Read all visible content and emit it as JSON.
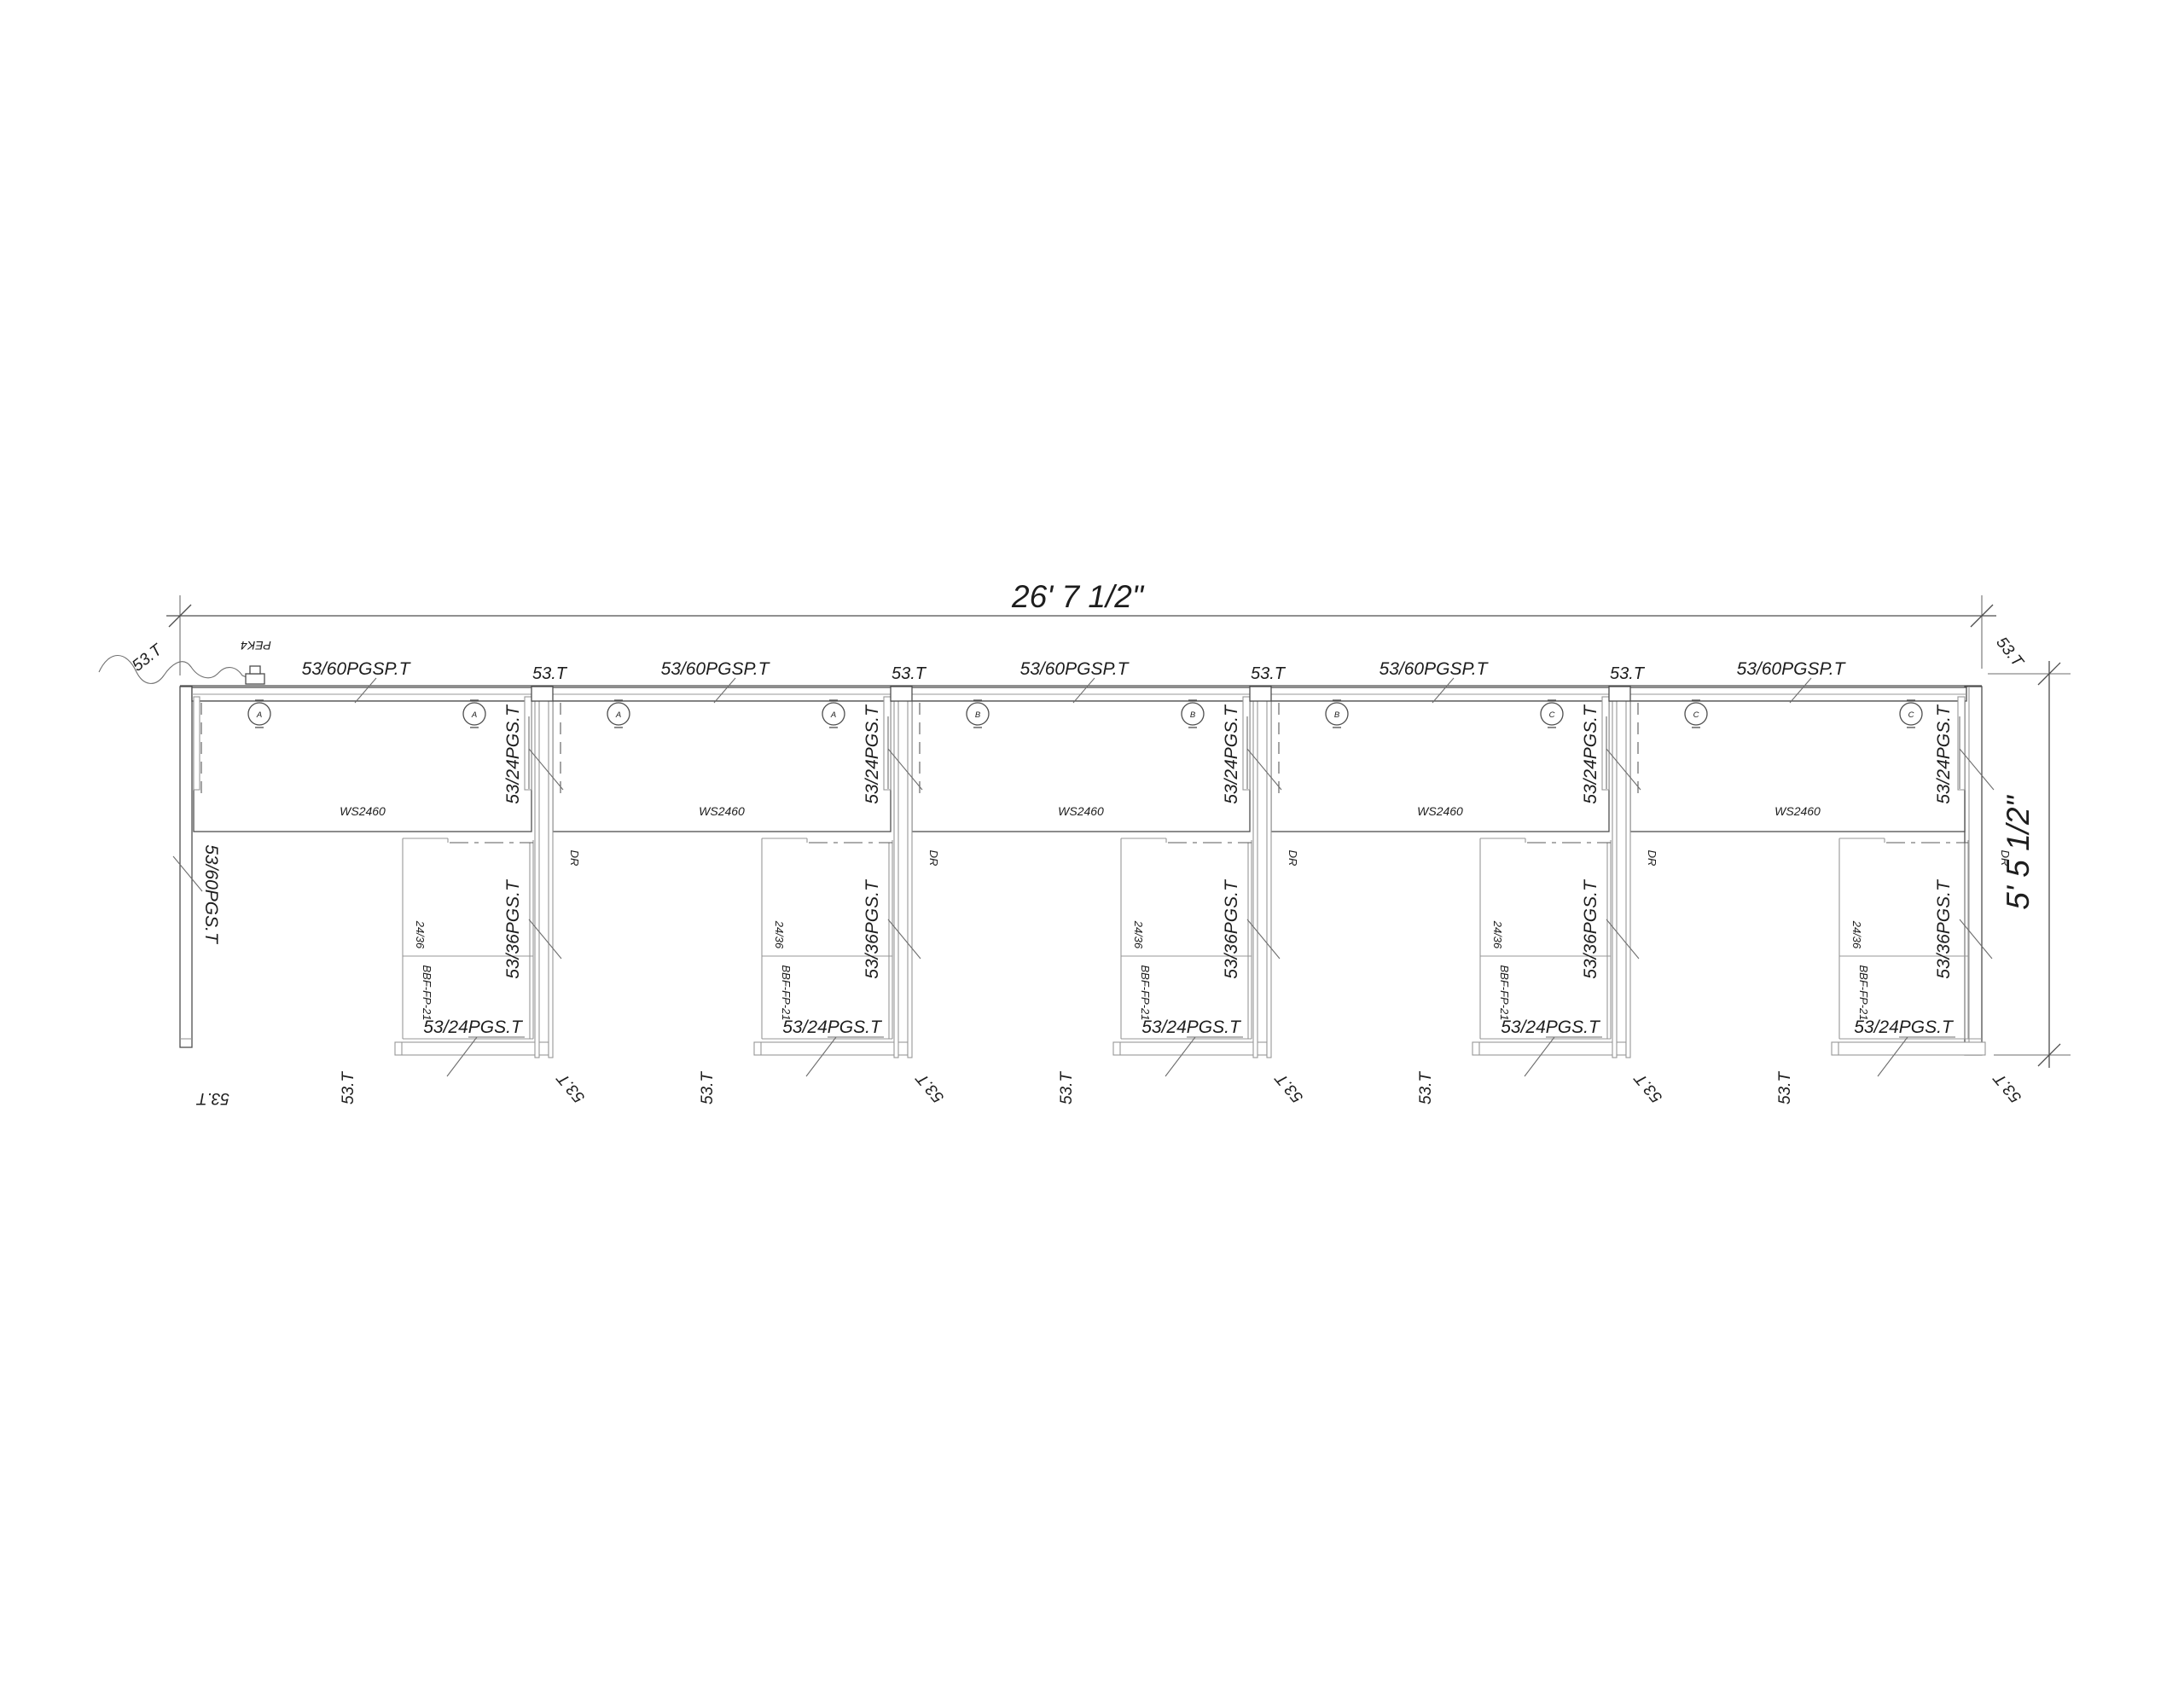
{
  "drawing": {
    "overall_width_label": "26' 7 1/2\"",
    "overall_depth_label": "5' 5 1/2\"",
    "power_entry_label": "PEK4",
    "cable_tag": "53.T",
    "connector_tag": "53.T",
    "top_panel_tag": "53/60PGSP.T",
    "left_end_panel_tag": "53/60PGS.T",
    "divider_upper_tag": "53/24PGS.T",
    "divider_lower_tag": "53/36PGS.T",
    "return_panel_tag": "53/24PGS.T",
    "drawer_tag": "DR",
    "pedestal_upper_tag": "24/36",
    "pedestal_lower_tag": "BBF-FP-21",
    "units": [
      {
        "worksurface": "WS2460",
        "grommets": [
          "A",
          "A"
        ]
      },
      {
        "worksurface": "WS2460",
        "grommets": [
          "A",
          "A"
        ]
      },
      {
        "worksurface": "WS2460",
        "grommets": [
          "B",
          "B"
        ]
      },
      {
        "worksurface": "WS2460",
        "grommets": [
          "B",
          "C"
        ]
      },
      {
        "worksurface": "WS2460",
        "grommets": [
          "C",
          "C"
        ]
      }
    ]
  }
}
